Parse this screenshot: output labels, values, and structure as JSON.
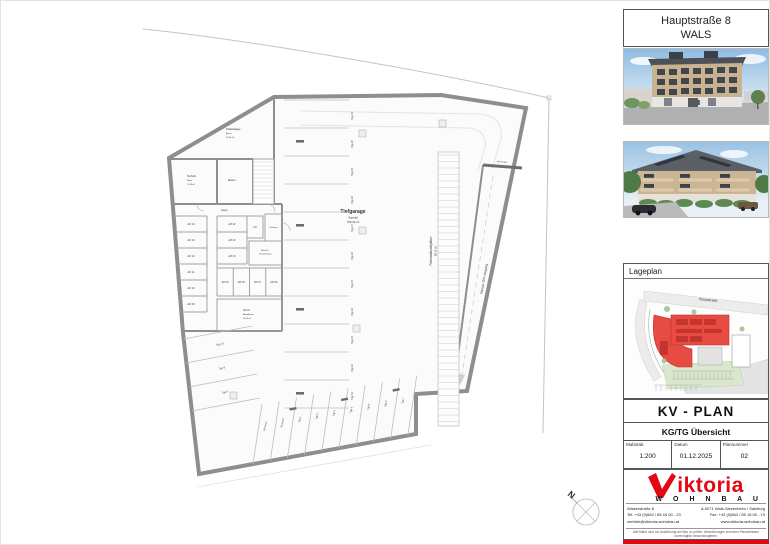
{
  "header": {
    "street": "Hauptstraße 8",
    "city": "WALS"
  },
  "lageplan": {
    "label": "Lageplan",
    "street_label": "Hauptstraße"
  },
  "titleblock": {
    "plan_type": "KV - PLAN",
    "plan_subtitle": "KG/TG Übersicht",
    "fields": [
      {
        "label": "Maßstab",
        "value": "1:200"
      },
      {
        "label": "Datum",
        "value": "01.12.2025"
      },
      {
        "label": "Plannummer",
        "value": "02"
      }
    ]
  },
  "logo": {
    "name_rest": "iktoria",
    "sub": "W O H N B A U",
    "contact_left": [
      "Walserstraße 8",
      "Tel. +43 (0)662 / 85 16 00 - 23",
      "vertrieb@viktoria-wohnbau.at"
    ],
    "contact_right": [
      "A-5071 Wals-Siezenheim / Salzburg",
      "Fax: +43 (0)662 / 85 16 00 - 19",
      "www.viktoria-wohnbau.at"
    ],
    "disclaimer": "Alle Maße sind vor Ausführung am Bau zu prüfen. Abweichungen sind dem Planverfasser unverzüglich bekanntzugeben."
  },
  "plan": {
    "tiefgarage": [
      "Tiefgarage",
      "Asphalt",
      "795,43 m²"
    ],
    "pelletslager": [
      "Pelletslager",
      "Beton",
      "33,40 m²"
    ],
    "technik": [
      "Technik",
      "Beton",
      "12,34 m²"
    ],
    "elektro": "Elektro",
    "gang": "Gang",
    "lift": "Lift",
    "schleuse": "Schleuse",
    "wasch": [
      "Wasch-/",
      "Trockenraum"
    ],
    "ar01": [
      "AR 01",
      "Abstellraum",
      "16,06 m²"
    ],
    "ar_left": [
      "AR 14",
      "AR 13",
      "AR 12",
      "AR 11",
      "AR 10",
      "AR 09"
    ],
    "ar_mid": [
      "AR 02",
      "AR 03",
      "AR 04"
    ],
    "ar_row": [
      "AR 05",
      "AR 06",
      "AR 07",
      "AR 08"
    ],
    "fahrrad": [
      "Fahrradabstellplätze",
      "58,75 m²"
    ],
    "rampe": "Rampe 15% Neigung",
    "sektionaltor": "Sektionaltor",
    "stalls_col": [
      "Tgp 21",
      "Tgp 20",
      "Tgp 19",
      "Tgp 18",
      "Tgp 17",
      "Tgp 16",
      "Tgp 15",
      "Tgp 14",
      "Tgp 13",
      "Tgp 12",
      "Tgp 11"
    ],
    "stalls_fan": [
      "Tgp 10",
      "Tgp 9",
      "Tgp 8"
    ],
    "stalls_bottom": [
      "Reserve",
      "Reserve",
      "Tgp 1",
      "Tgp 2",
      "Tgp 3",
      "Tgp 4",
      "Tgp 5",
      "Tgp 6",
      "Tgp 7"
    ],
    "north": "N"
  },
  "colors": {
    "accent_red": "#e30613",
    "site_red": "#e84b42",
    "wall_gray": "#8e8e8e"
  }
}
